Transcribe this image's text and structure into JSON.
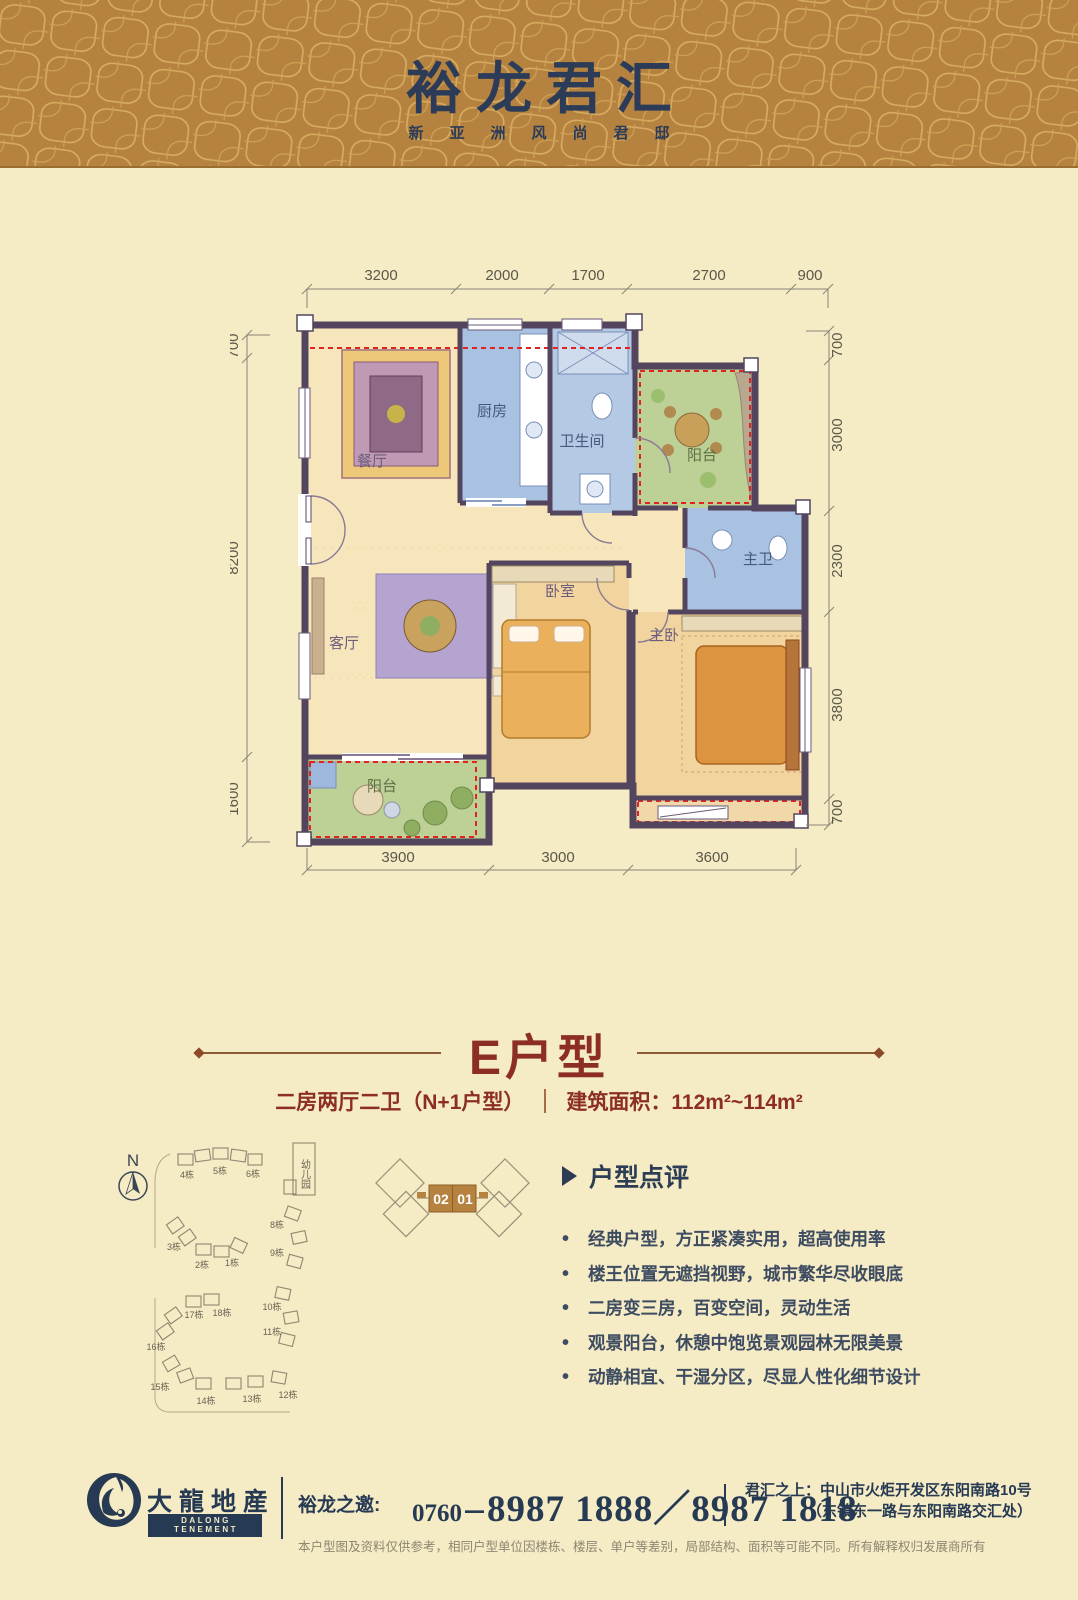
{
  "header": {
    "title": "裕龙君汇",
    "subtitle": "新亚洲风尚君邸"
  },
  "plan": {
    "dims_top": [
      "3200",
      "2000",
      "1700",
      "2700",
      "900"
    ],
    "dims_left": [
      "700",
      "8200",
      "1600"
    ],
    "dims_right": [
      "700",
      "3000",
      "2300",
      "3800",
      "700"
    ],
    "dims_bottom": [
      "3900",
      "3000",
      "3600"
    ],
    "rooms": {
      "dining": "餐厅",
      "kitchen": "厨房",
      "bath": "卫生间",
      "balcony_top": "阳台",
      "master_bath": "主卫",
      "living": "客厅",
      "bedroom": "卧室",
      "master_bedroom": "主卧",
      "balcony_bottom": "阳台"
    }
  },
  "type_header": {
    "title": "E户型",
    "subtitle_left": "二房两厅二卫（N+1户型）",
    "subtitle_right": "建筑面积：112m²~114m²"
  },
  "siteplan": {
    "north": "N",
    "kindergarten": "幼儿园",
    "buildings": [
      "4栋",
      "5栋",
      "6栋",
      "3栋",
      "2栋",
      "1栋",
      "8栋",
      "9栋",
      "17栋",
      "18栋",
      "16栋",
      "10栋",
      "11栋",
      "15栋",
      "14栋",
      "13栋",
      "12栋"
    ]
  },
  "unit_diagram": {
    "unit_left": "02",
    "unit_right": "01"
  },
  "review": {
    "title": "户型点评",
    "items": [
      "经典户型，方正紧凑实用，超高使用率",
      "楼王位置无遮挡视野，城市繁华尽收眼底",
      "二房变三房，百变空间，灵动生活",
      "观景阳台，休憩中饱览景观园林无限美景",
      "动静相宜、干湿分区，尽显人性化细节设计"
    ]
  },
  "footer": {
    "logo_cn": "大龍地産",
    "logo_en": "DALONG TENEMENT",
    "phone_label": "裕龙之邀:",
    "phone_prefix": "0760－",
    "phone_numbers": "8987 1888／8987 1818",
    "address_label": "君汇之上：",
    "address_line1": "中山市火炬开发区东阳南路10号",
    "address_line2": "（东镇东一路与东阳南路交汇处）",
    "disclaimer": "本户型图及资料仅供参考，相同户型单位因楼栋、楼层、单户等差别，局部结构、面积等可能不同。所有解释权归发展商所有"
  },
  "colors": {
    "header_gold": "#b5823f",
    "pattern_gold": "#d8ae62",
    "navy": "#2c3c58",
    "cream": "#f5ebc4",
    "maroon": "#8c2e26",
    "wall_purple": "#54455f",
    "red_dash": "#e32222",
    "blue_room": "#a9c2e1",
    "green_room": "#bdd096",
    "warm_room": "#f2d49e"
  }
}
